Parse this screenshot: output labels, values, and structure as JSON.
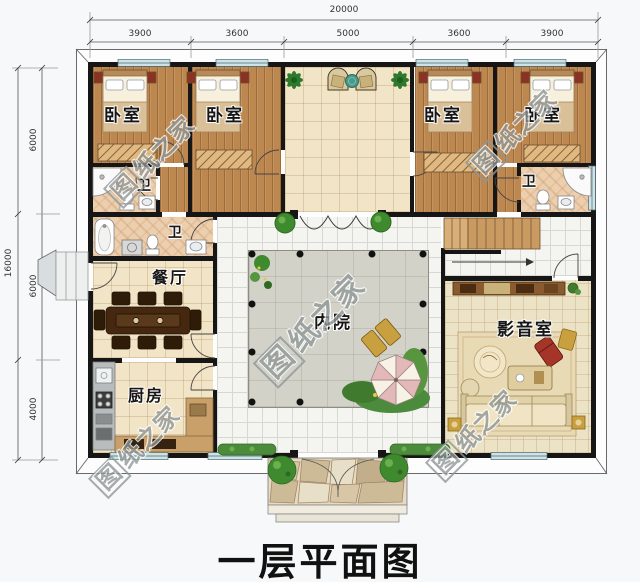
{
  "title": "一层平面图",
  "watermark": {
    "boxed": "图",
    "rest": "纸之家",
    "full": "图纸之家"
  },
  "dims": {
    "top_total": "20000",
    "top_segments": [
      "3900",
      "3600",
      "5000",
      "3600",
      "3900"
    ],
    "left_total": "16000",
    "left_segments": [
      "6000",
      "6000",
      "4000"
    ]
  },
  "rooms": {
    "bedroom": "卧室",
    "bathroom": "卫",
    "dining": "餐厅",
    "kitchen": "厨房",
    "courtyard": "内院",
    "media": "影音室"
  },
  "colors": {
    "wall": "#161616",
    "wood_floor": "#bd8750",
    "tile_floor": "#f2e4c6",
    "walkway": "#f4f4f1",
    "courtyard_paving": "#d2d2c9",
    "window": "#cfe3e6",
    "greenery": "#3f8a2f",
    "sofa_cream": "#f0e4c4",
    "accent_red": "#a53528",
    "parasol_pink": "#e2b8b8",
    "gold_furniture": "#c9a040"
  }
}
